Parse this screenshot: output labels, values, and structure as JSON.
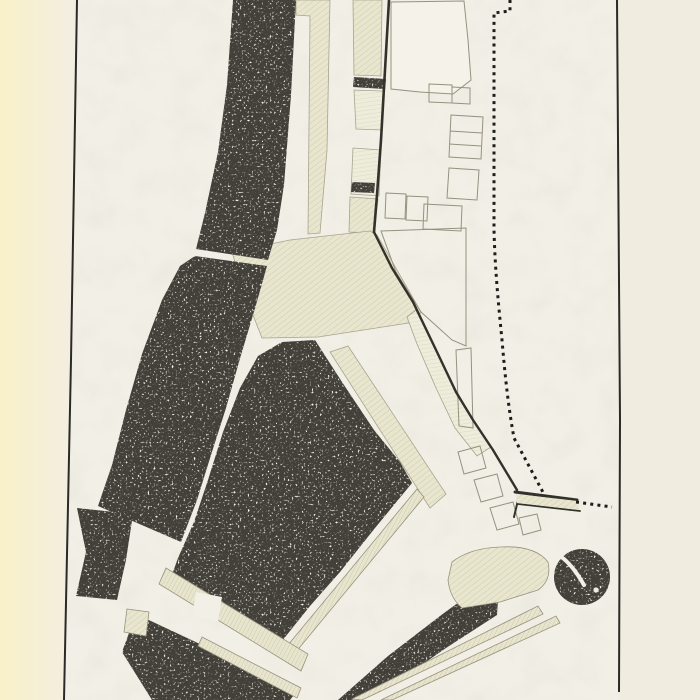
{
  "figure": {
    "kind": "scanned-engraved-town-plan",
    "description": "Scanned book plate of an engraved town plan: dark stippled city blocks separated by white streets, a curving fortification wall, a dotted boundary line on the right, hatched rampart and glacis strips at the bottom, outlined building footprints to the east of the wall, and a round bastion tower at lower right. No text is printed on the plate.",
    "features": {
      "north_block_band": "dark stippled block band (top)",
      "west_block_band": "curved dark block band (west)",
      "central_block": "large pentagonal dark block (centre)",
      "southwest_blocks": "small dark blocks (south-west)",
      "south_rampart_band": "dark rampart band (south)",
      "southeast_wedge": "tapering dark wedge (south-east)",
      "bastion_tower": "round dark bastion tower (lower right)",
      "fortification_wall": "solid fortification wall line",
      "boundary_dotted_line": "dotted boundary line (east)",
      "hatched_strips": "hatched rampart / glacis strips",
      "building_outlines": "outlined building footprints east of the wall",
      "plate_border_left": "left plate border rule",
      "plate_border_right": "right plate border rule"
    },
    "colors": {
      "page": "#f2efe6",
      "page_edge_yellow": "#f9f3cf",
      "block_ink": "#43403a",
      "speck_cream": "#f1e9d8",
      "hatch_beige": "#e9e6cf",
      "hatch_beige_light": "#eeecdb",
      "outline_gray": "#96917f",
      "wall_ink": "#33312b",
      "border_ink": "#2b2a26",
      "dotted_ink": "#1e1d1a"
    }
  }
}
